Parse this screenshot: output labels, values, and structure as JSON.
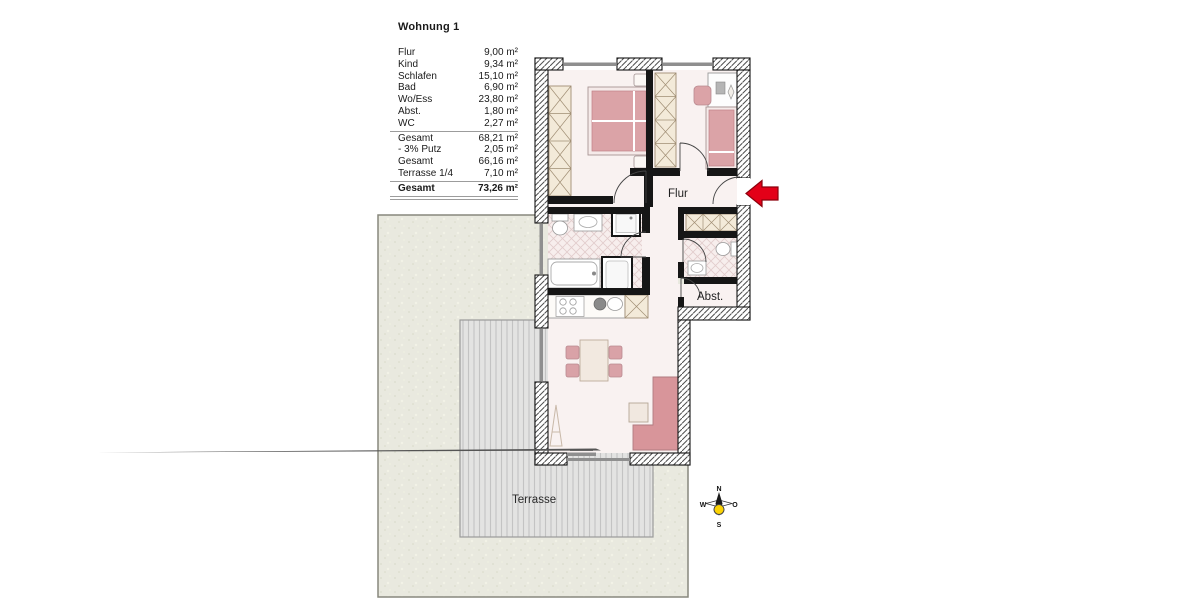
{
  "title": "Wohnung 1",
  "area_table": {
    "rows": [
      {
        "label": "Flur",
        "value": "9,00 m²"
      },
      {
        "label": "Kind",
        "value": "9,34 m²"
      },
      {
        "label": "Schlafen",
        "value": "15,10 m²"
      },
      {
        "label": "Bad",
        "value": "6,90 m²"
      },
      {
        "label": "Wo/Ess",
        "value": "23,80 m²"
      },
      {
        "label": "Abst.",
        "value": "1,80 m²"
      },
      {
        "label": "WC",
        "value": "2,27 m²"
      },
      {
        "label": "Gesamt",
        "value": "68,21 m²"
      },
      {
        "label": "- 3% Putz",
        "value": "2,05 m²"
      },
      {
        "label": "Gesamt",
        "value": "66,16 m²"
      },
      {
        "label": "Terrasse 1/4",
        "value": "7,10 m²"
      },
      {
        "label": "Gesamt",
        "value": "73,26 m²"
      }
    ]
  },
  "plan": {
    "labels": {
      "hall": "Flur",
      "storage": "Abst.",
      "terrace": "Terrasse"
    },
    "compass": {
      "north": "N",
      "east": "O",
      "south": "S",
      "west": "W"
    },
    "colors": {
      "arrow_red": "#e30018",
      "wall_black": "#161616",
      "furniture_pink": "#dba3a7",
      "sofa_pink": "#d8959a",
      "wardrobe_beige": "#f3ead9",
      "floor": "#f9f2f1",
      "garden": "#e9e9df",
      "terrace": "#e3e3e2",
      "compass_yellow": "#fcd303"
    }
  }
}
